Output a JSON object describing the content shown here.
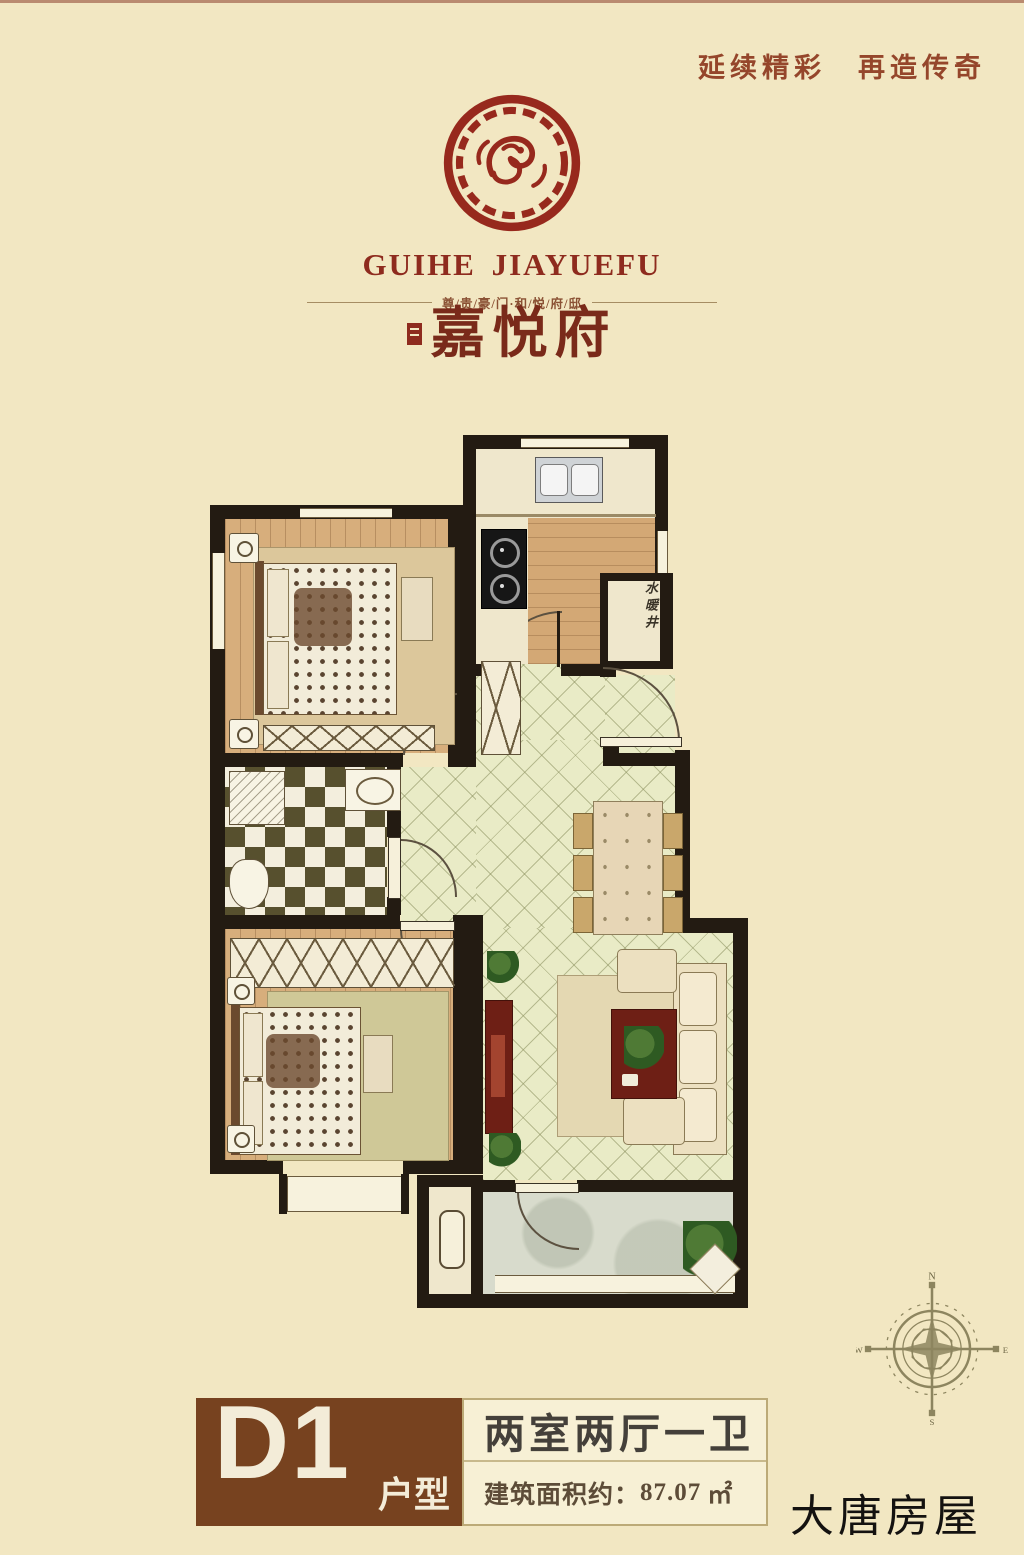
{
  "header": {
    "slogan": "延续精彩　再造传奇",
    "brand_en": "GUIHE JIAYUEFU",
    "tagline": "尊/贵/豪/门·和/悦/府/邸",
    "brand_cn": "嘉悦府"
  },
  "floorplan": {
    "shaft_label": "水暖井"
  },
  "compass": {
    "n": "N",
    "e": "E",
    "s": "S",
    "w": "W"
  },
  "footer": {
    "unit_code": "D1",
    "unit_suffix": "户型",
    "layout_text": "两室两厅一卫",
    "area_label": "建筑面积约：",
    "area_value": "87.07",
    "area_unit": "㎡",
    "watermark": "大唐房屋"
  },
  "colors": {
    "brand_red": "#8e2b1e",
    "box_brown": "#77421f",
    "wall_black": "#231b12",
    "background_cream": "#f2e7c2"
  }
}
